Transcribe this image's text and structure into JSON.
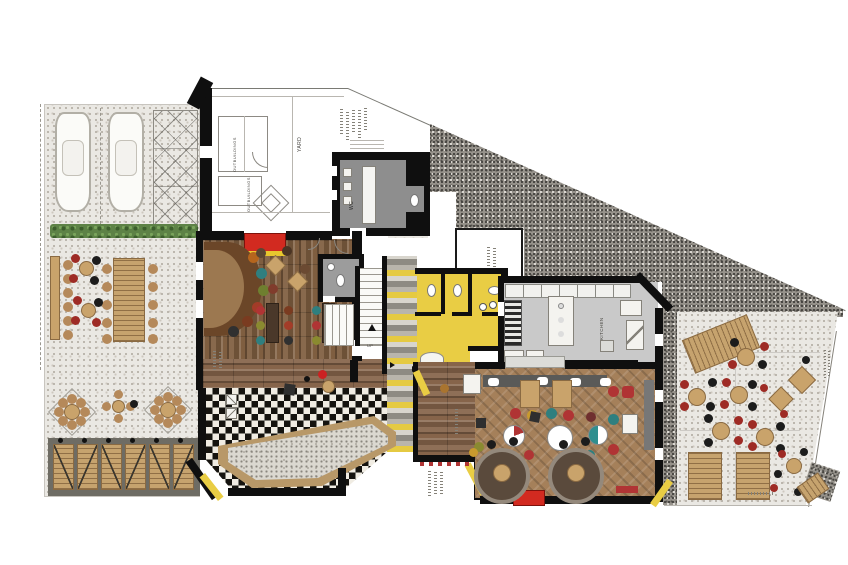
{
  "drawing": {
    "kind": "restaurant ground floor plan with parking, yard and terraces"
  },
  "labels": {
    "yard": "YARD",
    "outbuildings_1": "OUTBUILDINGS",
    "outbuildings_2": "OUTBUILDINGS",
    "wc": "WC",
    "kitchen": "KITCHEN",
    "up": "UP"
  },
  "palette": {
    "entrance_mat_red": "#d22a20",
    "entrance_mat_yellow": "#e8c72e",
    "chair_red": "#9e2b25",
    "chair_black": "#1c1c1c",
    "chair_teal": "#2f7f7f",
    "chair_mustard": "#c89a2e",
    "wood_tan": "#c9a36b",
    "gravel_light": "#eae8e3",
    "gravel_dark": "#96928b",
    "wc_yellow": "#e9cd44",
    "kitchen_gray": "#c9c9c9",
    "hedge_green": "#5d8246"
  }
}
